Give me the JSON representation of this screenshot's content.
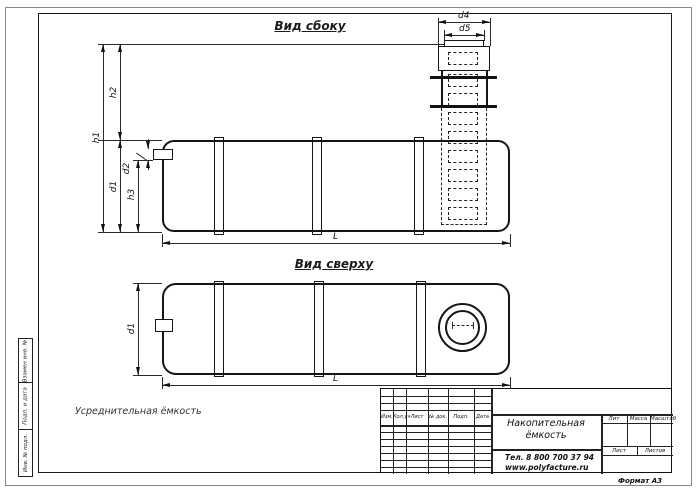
{
  "drawing": {
    "side_view": {
      "title": "Вид сбоку"
    },
    "top_view": {
      "title": "Вид сверху"
    },
    "dims": {
      "h1": "h1",
      "h2": "h2",
      "h3": "h3",
      "d1": "d1",
      "d2": "d2",
      "d4": "d4",
      "d5": "d5",
      "L": "L"
    },
    "note": "Усреднительная ёмкость"
  },
  "margin_stamps": [
    "Взамен инв. №",
    "Подп. и дата",
    "Инв. № подл."
  ],
  "title_block": {
    "columns": [
      "Изм.",
      "Кол.уч",
      "Лист",
      "№ док.",
      "Подп.",
      "Дата"
    ],
    "product_title_line1": "Накопительная",
    "product_title_line2": "ёмкость",
    "phone": "Тел. 8 800 700 37 94",
    "website": "www.polyfacture.ru",
    "lit_label": "Лит",
    "mass_label": "Масса",
    "scale_label": "Масштаб",
    "sheet_label": "Лист",
    "sheets_label": "Листов",
    "format_label": "Формат  А3"
  },
  "colors": {
    "line": "#1c1c1c",
    "paper": "#ffffff"
  }
}
